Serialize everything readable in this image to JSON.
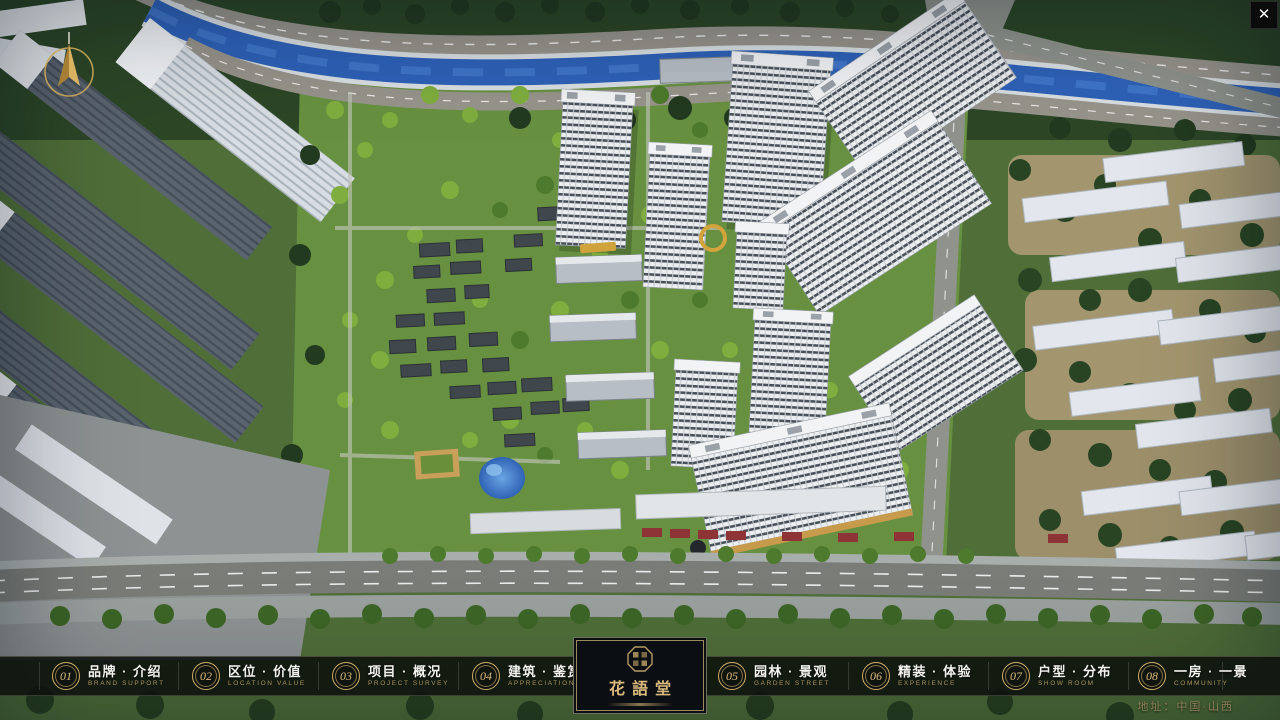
{
  "window": {
    "close_glyph": "✕"
  },
  "nav": {
    "items": [
      {
        "num": "01",
        "label": "品牌 · 介绍",
        "sub": "BRAND SUPPORT"
      },
      {
        "num": "02",
        "label": "区位 · 价值",
        "sub": "LOCATION VALUE"
      },
      {
        "num": "03",
        "label": "项目 · 概况",
        "sub": "PROJECT SURVEY"
      },
      {
        "num": "04",
        "label": "建筑 · 鉴赏",
        "sub": "APPRECIATION"
      },
      {
        "num": "05",
        "label": "园林 · 景观",
        "sub": "GARDEN STREET"
      },
      {
        "num": "06",
        "label": "精装 · 体验",
        "sub": "EXPERIENCE"
      },
      {
        "num": "07",
        "label": "户型 · 分布",
        "sub": "SHOW ROOM"
      },
      {
        "num": "08",
        "label": "一房 · 一景",
        "sub": "COMMUNITY"
      }
    ]
  },
  "logo": {
    "title": "花語堂"
  },
  "footer": {
    "address": "地址：中国·山西"
  },
  "colors": {
    "gold": "#cfae6a",
    "bar_bg": "rgba(13,17,13,0.88)",
    "river": "#2e62b8",
    "lawn": "#679140"
  }
}
